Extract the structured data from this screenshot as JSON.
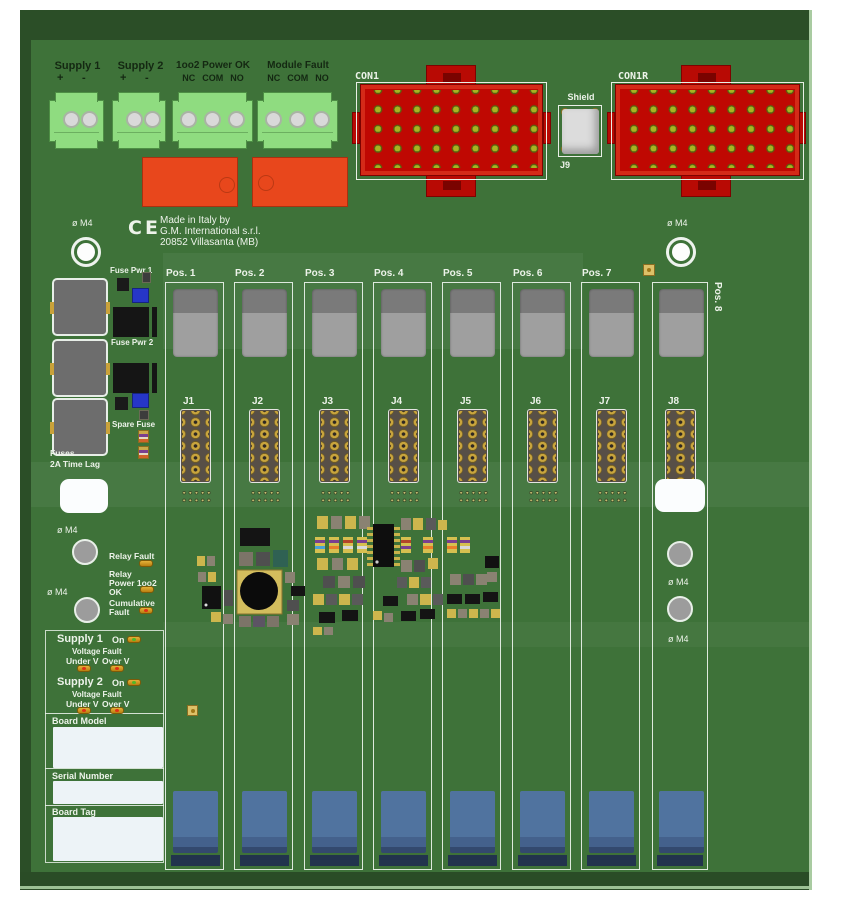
{
  "colors": {
    "board_green": "#3e7239",
    "board_edge_dark": "#2b4e27",
    "silkscreen_white": "#edf3ea",
    "connector_red": "#bf0802",
    "terminal_green": "#8fdc80",
    "relay_orange": "#e8471c",
    "fuse_gray": "#6d6d6d",
    "module_blue": "#50739f",
    "led_amber": "#c89018",
    "led_on_green": "#4db82a",
    "led_fault_red": "#e03014",
    "pin_olive": "#a8b322",
    "pad_gold": "#c9a53d"
  },
  "top_terminals": [
    {
      "label": "Supply 1",
      "pin_labels": [
        "+",
        "-"
      ]
    },
    {
      "label": "Supply 2",
      "pin_labels": [
        "+",
        "-"
      ]
    },
    {
      "label": "1oo2 Power OK",
      "pin_labels": [
        "NC",
        "COM",
        "NO"
      ]
    },
    {
      "label": "Module Fault",
      "pin_labels": [
        "NC",
        "COM",
        "NO"
      ]
    }
  ],
  "connectors": {
    "con1": "CON1",
    "con1r": "CON1R",
    "shield_label": "Shield",
    "shield_ref": "J9"
  },
  "maker": {
    "ce": "CE",
    "lines": [
      "Made in Italy by",
      "G.M. International s.r.l.",
      "20852 Villasanta (MB)"
    ]
  },
  "mount": {
    "m4": "ø M4"
  },
  "fuses": {
    "pwr1": "Fuse Pwr 1",
    "pwr2": "Fuse Pwr 2",
    "spare": "Spare Fuse",
    "rating_line1": "Fuses",
    "rating_line2": "2A Time Lag"
  },
  "positions": [
    {
      "pos": "Pos. 1",
      "jack": "J1"
    },
    {
      "pos": "Pos. 2",
      "jack": "J2"
    },
    {
      "pos": "Pos. 3",
      "jack": "J3"
    },
    {
      "pos": "Pos. 4",
      "jack": "J4"
    },
    {
      "pos": "Pos. 5",
      "jack": "J5"
    },
    {
      "pos": "Pos. 6",
      "jack": "J6"
    },
    {
      "pos": "Pos. 7",
      "jack": "J7"
    },
    {
      "pos": "Pos. 8",
      "jack": "J8"
    }
  ],
  "status": {
    "relay_fault": "Relay Fault",
    "relay_power": [
      "Relay",
      "Power 1oo2",
      "OK"
    ],
    "cumulative": [
      "Cumulative",
      "Fault"
    ]
  },
  "supplies": [
    {
      "name": "Supply 1",
      "on": "On",
      "fault": "Voltage Fault",
      "under": "Under V",
      "over": "Over V"
    },
    {
      "name": "Supply 2",
      "on": "On",
      "fault": "Voltage Fault",
      "under": "Under V",
      "over": "Over V"
    }
  ],
  "fields": {
    "board_model": "Board Model",
    "serial_number": "Serial Number",
    "board_tag": "Board Tag"
  }
}
